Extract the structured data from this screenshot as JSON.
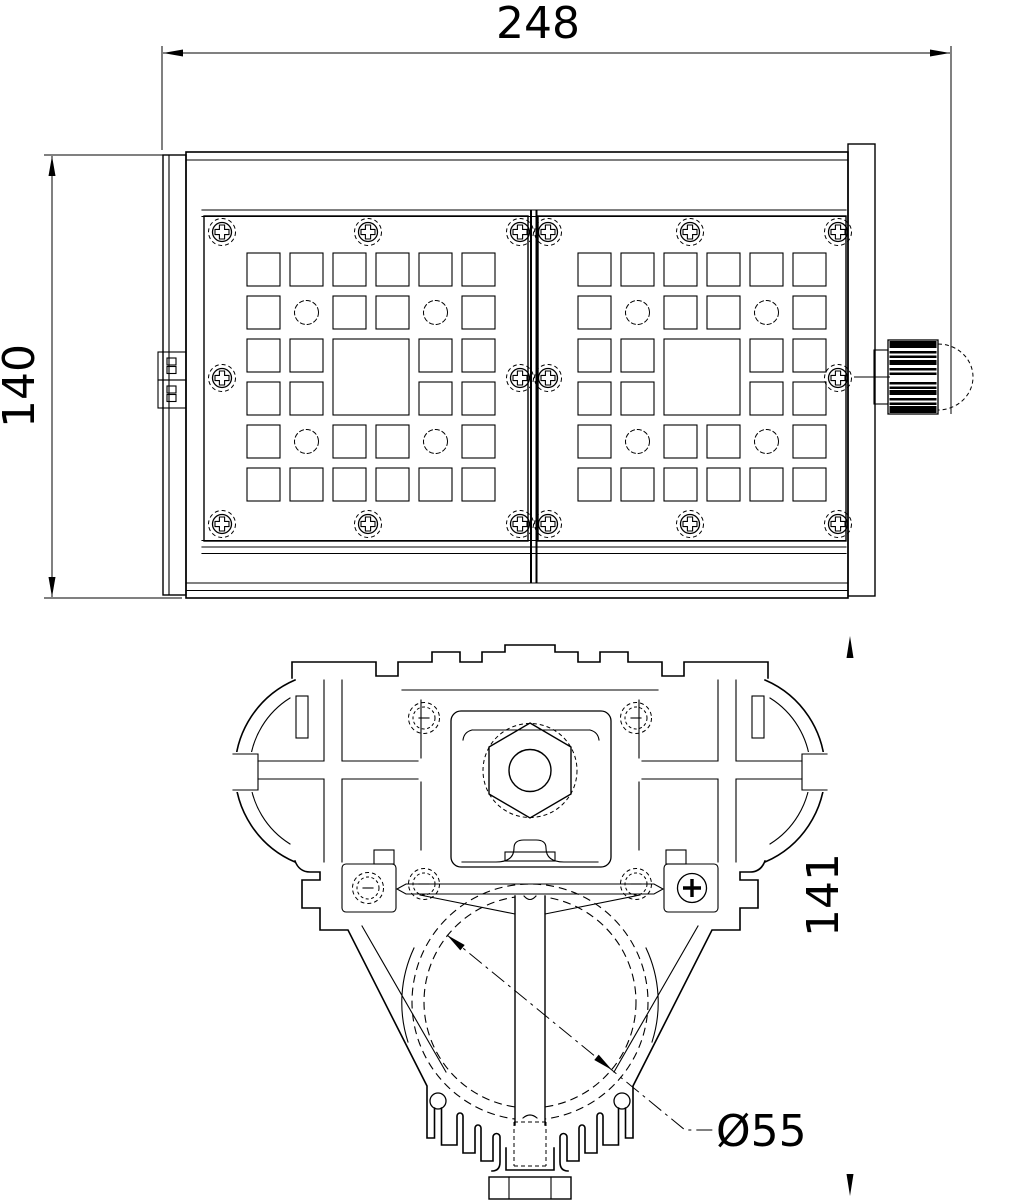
{
  "page": {
    "background": "#ffffff",
    "ink": "#000000"
  },
  "views": {
    "front": {
      "width_mm": "248",
      "height_mm": "140"
    },
    "section": {
      "height_mm": "141",
      "bore_diameter": "Ø55"
    }
  }
}
